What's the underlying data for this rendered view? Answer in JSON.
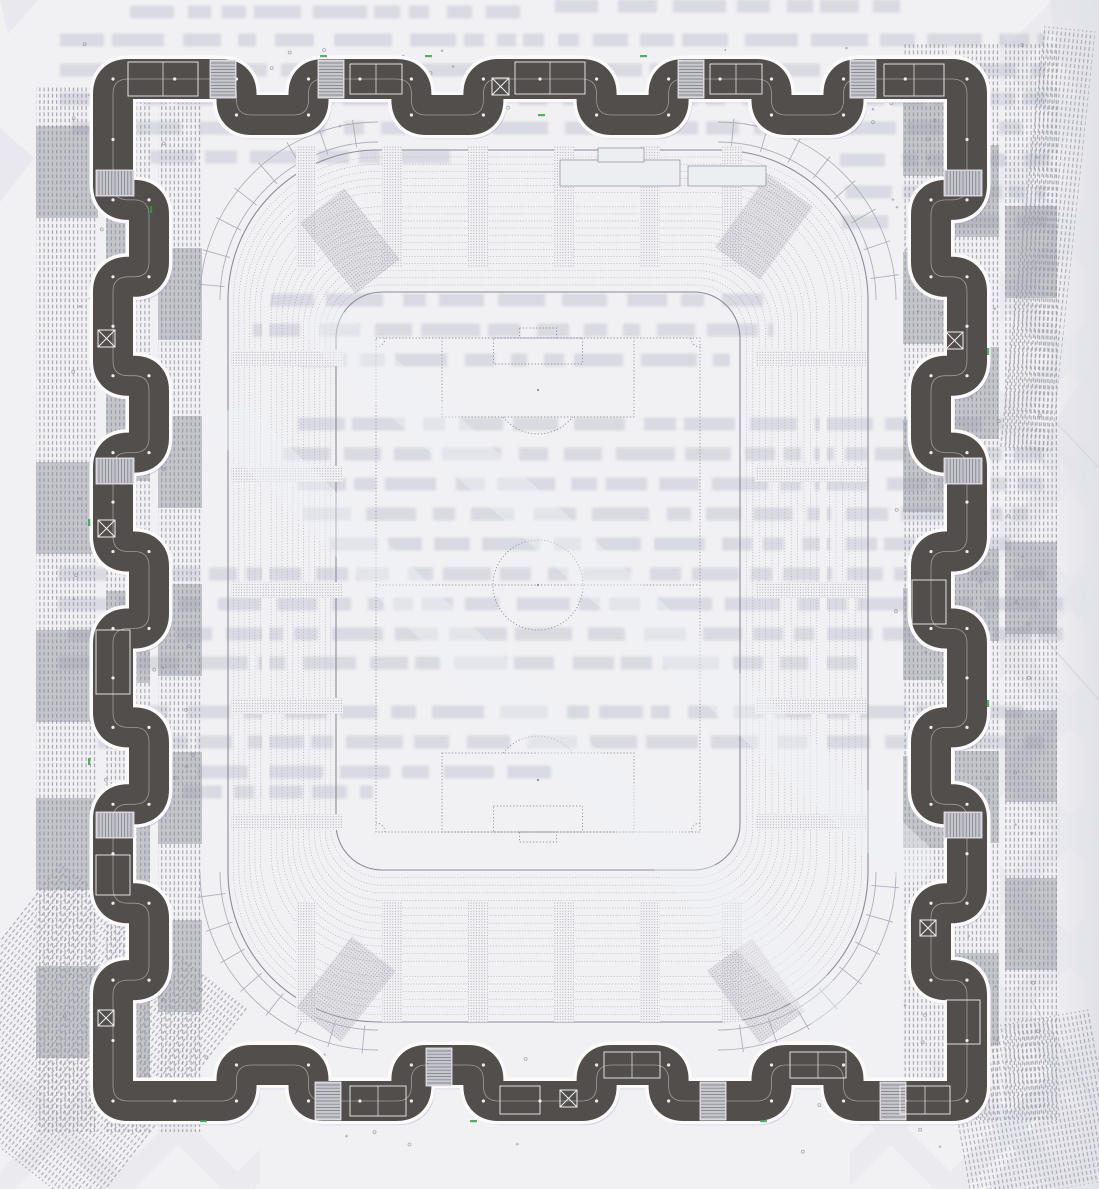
{
  "canvas": {
    "w": 1099,
    "h": 1189
  },
  "colors": {
    "paper": "#f1f1f4",
    "paper_edge": "#dddde4",
    "watermark": "#e2e3ea",
    "bleed": "#b9bac7",
    "ring_fill": "#514e4b",
    "ring_edge": "#fafafa",
    "ring_corridor": "#dcdcdc",
    "ring_fringe": "#8d7bc0",
    "stripe": "#9c9ca8",
    "stripe_block": "#8e8e9a",
    "seat_line": "#a4a4b1",
    "seat_line_dark": "#8c8c99",
    "stipple": "#9b9ba8",
    "pitch_line": "#8f8f9c",
    "dot": "#8a8a96",
    "speck": "#6f6f78",
    "stair_fill": "#c6c6cd",
    "stair_tread": "#76767c",
    "detail_line": "#f0f0f2",
    "platform_fill": "#edeef1",
    "streak": "#f0f1f5",
    "artifact_green": "#2f9e3e"
  },
  "bleed_rows": [
    [
      555,
      6,
      345
    ],
    [
      130,
      12,
      390
    ],
    [
      60,
      40,
      985
    ],
    [
      60,
      70,
      985
    ],
    [
      60,
      99,
      985
    ],
    [
      72,
      128,
      950
    ],
    [
      150,
      157,
      300
    ],
    [
      840,
      160,
      210
    ],
    [
      846,
      192,
      200
    ],
    [
      842,
      222,
      205
    ],
    [
      268,
      300,
      495
    ],
    [
      253,
      330,
      520
    ],
    [
      300,
      360,
      430
    ],
    [
      298,
      424,
      705
    ],
    [
      283,
      454,
      760
    ],
    [
      298,
      484,
      745
    ],
    [
      303,
      514,
      725
    ],
    [
      330,
      544,
      680
    ],
    [
      58,
      574,
      1005
    ],
    [
      58,
      604,
      1005
    ],
    [
      68,
      634,
      995
    ],
    [
      58,
      663,
      810
    ],
    [
      118,
      712,
      905
    ],
    [
      98,
      742,
      945
    ],
    [
      198,
      772,
      365
    ],
    [
      118,
      792,
      255
    ]
  ],
  "watermarks": {
    "polys": [
      "1050,0 1099,0 1099,132 1058,56",
      "1099,352 1046,436 1099,518",
      "1099,556 1062,598 1099,640",
      "988,1189 1058,1092 1099,1140 1099,1189",
      "0,128 34,158 0,202",
      "0,0 38,0 8,34"
    ],
    "creases": [
      [
        1046,
        640,
        1099,
        700
      ],
      [
        1032,
        1002,
        1099,
        1108
      ],
      [
        1054,
        420,
        1099,
        468
      ]
    ],
    "strips": [
      [
        1000,
        0,
        99,
        1189
      ],
      [
        850,
        1060,
        249,
        129
      ],
      [
        0,
        1080,
        260,
        109
      ]
    ]
  },
  "stripes": {
    "left": {
      "y": 86,
      "h": 1046,
      "groups": [
        {
          "x": 36,
          "w": 62
        },
        {
          "x": 106,
          "w": 44
        },
        {
          "x": 158,
          "w": 44
        }
      ]
    },
    "right": {
      "y": 44,
      "h": 1076,
      "groups": [
        {
          "x": 903,
          "w": 44
        },
        {
          "x": 955,
          "w": 44
        },
        {
          "x": 1005,
          "w": 52
        }
      ]
    },
    "fans": [
      {
        "rot": 38,
        "cx": 70,
        "cy": 1010,
        "x": -30,
        "y": 900,
        "w": 240,
        "h": 262
      },
      {
        "rot": -10,
        "cx": 1035,
        "cy": 1100,
        "x": 955,
        "y": 1020,
        "w": 150,
        "h": 172
      },
      {
        "rot": 6,
        "cx": 1060,
        "cy": 80,
        "x": 1036,
        "y": 28,
        "w": 54,
        "h": 424
      }
    ],
    "block_h": 92,
    "block_step": 168
  },
  "dots": {
    "seed": 9,
    "attempts": 360,
    "exclude": [
      205,
      128,
      893,
      1052
    ],
    "area": [
      60,
      44,
      1040,
      1152
    ]
  },
  "ladders": {
    "r1": 158,
    "r2": 178,
    "tick_deg": 11,
    "corners": [
      [
        378,
        300,
        180,
        270
      ],
      [
        718,
        300,
        270,
        360
      ],
      [
        718,
        872,
        0,
        90
      ],
      [
        378,
        872,
        90,
        180
      ]
    ]
  },
  "bowl": {
    "outer": {
      "x": 228,
      "y": 150,
      "w": 640,
      "h": 872,
      "r": 150
    },
    "inner": {
      "x": 336,
      "y": 292,
      "w": 404,
      "h": 578,
      "r": 46
    },
    "rings": 21,
    "walkway": 7
  },
  "aisles": {
    "top_xs": [
      296,
      382,
      468,
      554,
      640,
      722
    ],
    "top_y": 146,
    "top_h": 122,
    "v_w": 20,
    "side_ys": [
      350,
      466,
      582,
      698,
      814
    ],
    "left_x": 231,
    "right_x": 755,
    "s_w": 112,
    "s_h": 16,
    "bottom_y": 902,
    "bottom_h": 120
  },
  "wedges": [
    [
      322,
      196,
      -38
    ],
    [
      736,
      182,
      36
    ],
    [
      728,
      946,
      -36
    ],
    [
      318,
      944,
      38
    ]
  ],
  "wedge_size": [
    56,
    90
  ],
  "platforms": [
    [
      560,
      160,
      120,
      26
    ],
    [
      598,
      148,
      46,
      14
    ],
    [
      688,
      166,
      78,
      20
    ]
  ],
  "pitch": {
    "x": 376,
    "y": 338,
    "w": 324,
    "h": 494,
    "pen_w": 192,
    "pen_d": 79,
    "goal_w": 89,
    "goal_d": 26,
    "net_w": 37,
    "net_d": 10,
    "spot": 52,
    "circle_r": 45,
    "arc_r": 44,
    "corner": 9
  },
  "ring": {
    "rect": {
      "left": 113,
      "right": 967,
      "top": 79,
      "bottom": 1101
    },
    "amp": 36,
    "stroke": 40,
    "edge": 47,
    "corner_r": 15,
    "bays": {
      "top": [
        1.2,
        0.7,
        1.0,
        0.7,
        1.1,
        0.7,
        1.0,
        0.7,
        1.2
      ],
      "right": [
        1.1,
        0.7,
        0.9,
        0.7,
        0.9,
        0.7,
        0.9,
        0.7,
        0.9,
        0.7,
        1.1
      ],
      "bottom": [
        1.2,
        0.7,
        1.0,
        0.7,
        1.1,
        0.7,
        1.0,
        0.7,
        1.2
      ],
      "left": [
        1.1,
        0.7,
        0.9,
        0.7,
        0.9,
        0.7,
        0.9,
        0.7,
        0.9,
        0.7,
        1.1
      ]
    },
    "details": [
      [
        "room",
        128,
        62,
        70,
        34
      ],
      [
        "stairs",
        210,
        60,
        26,
        38
      ],
      [
        "stairs",
        318,
        60,
        26,
        38
      ],
      [
        "room",
        350,
        64,
        52,
        30
      ],
      [
        "lift",
        492,
        78,
        17,
        17
      ],
      [
        "room",
        515,
        62,
        70,
        32
      ],
      [
        "stairs",
        678,
        60,
        26,
        38
      ],
      [
        "room",
        710,
        64,
        52,
        30
      ],
      [
        "stairs",
        850,
        60,
        26,
        38
      ],
      [
        "room",
        884,
        64,
        60,
        32
      ],
      [
        "stairs",
        96,
        170,
        38,
        26
      ],
      [
        "lift",
        98,
        330,
        17,
        17
      ],
      [
        "stairs",
        96,
        458,
        38,
        26
      ],
      [
        "lift",
        98,
        520,
        17,
        17
      ],
      [
        "room",
        96,
        630,
        34,
        64
      ],
      [
        "stairs",
        96,
        812,
        38,
        26
      ],
      [
        "room",
        96,
        855,
        34,
        40
      ],
      [
        "lift",
        98,
        1010,
        16,
        16
      ],
      [
        "stairs",
        944,
        170,
        38,
        26
      ],
      [
        "lift",
        946,
        332,
        17,
        17
      ],
      [
        "stairs",
        944,
        458,
        38,
        26
      ],
      [
        "room",
        912,
        580,
        34,
        44
      ],
      [
        "stairs",
        944,
        812,
        38,
        26
      ],
      [
        "lift",
        920,
        920,
        16,
        16
      ],
      [
        "room",
        946,
        1000,
        34,
        44
      ],
      [
        "stairs",
        315,
        1082,
        26,
        38
      ],
      [
        "room",
        350,
        1086,
        56,
        30
      ],
      [
        "stairs",
        426,
        1048,
        26,
        38
      ],
      [
        "room",
        500,
        1086,
        40,
        28
      ],
      [
        "lift",
        560,
        1090,
        17,
        17
      ],
      [
        "room",
        604,
        1052,
        56,
        26
      ],
      [
        "stairs",
        700,
        1082,
        26,
        38
      ],
      [
        "room",
        790,
        1052,
        56,
        26
      ],
      [
        "stairs",
        880,
        1082,
        26,
        38
      ],
      [
        "room",
        900,
        1086,
        50,
        28
      ]
    ]
  },
  "streaks": [
    [
      240,
      430,
      830,
      1010
    ],
    [
      330,
      330,
      910,
      860
    ]
  ],
  "artifacts": {
    "green": [
      [
        320,
        55,
        7,
        2.2
      ],
      [
        425,
        55,
        7,
        2.2
      ],
      [
        640,
        55,
        7,
        2.2
      ],
      [
        88,
        519,
        2.2,
        7
      ],
      [
        88,
        758,
        2.2,
        7
      ],
      [
        987,
        348,
        2.2,
        7
      ],
      [
        987,
        700,
        2.2,
        7
      ],
      [
        200,
        1120,
        7,
        2.2
      ],
      [
        470,
        1120,
        7,
        2.2
      ],
      [
        760,
        1120,
        7,
        2.2
      ],
      [
        538,
        114,
        7,
        2.2
      ],
      [
        150,
        206,
        2.2,
        7
      ]
    ]
  }
}
